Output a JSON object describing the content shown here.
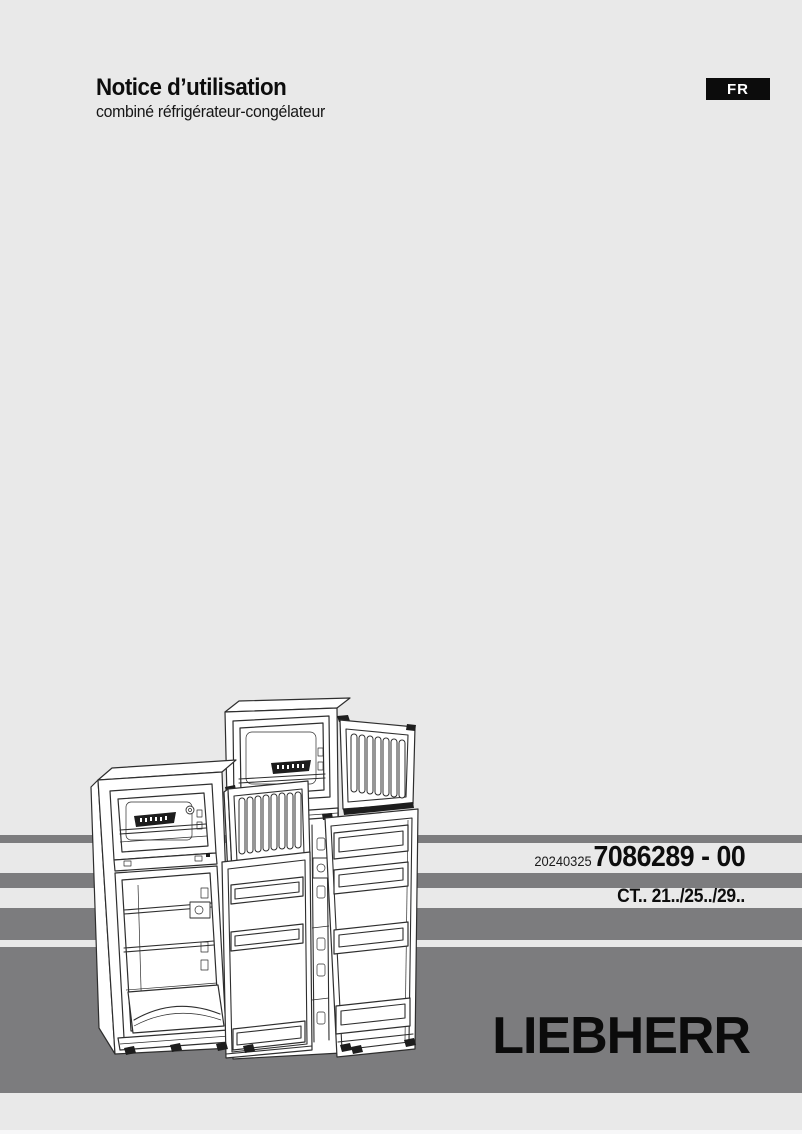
{
  "page": {
    "background_color": "#e9e9e9",
    "band_color": "#7c7c7e"
  },
  "header": {
    "title": "Notice d’utilisation",
    "subtitle": "combiné réfrigérateur-congélateur",
    "language_badge": "FR"
  },
  "document": {
    "date_code": "20240325",
    "part_number": "7086289 - 00",
    "models": "CT.. 21../25../29.."
  },
  "brand": {
    "logo_text": "LIEBHERR"
  },
  "illustration": {
    "description": "Line drawing of two top-freezer refrigerator-freezer combinations shown with freezer and refrigerator doors open"
  }
}
